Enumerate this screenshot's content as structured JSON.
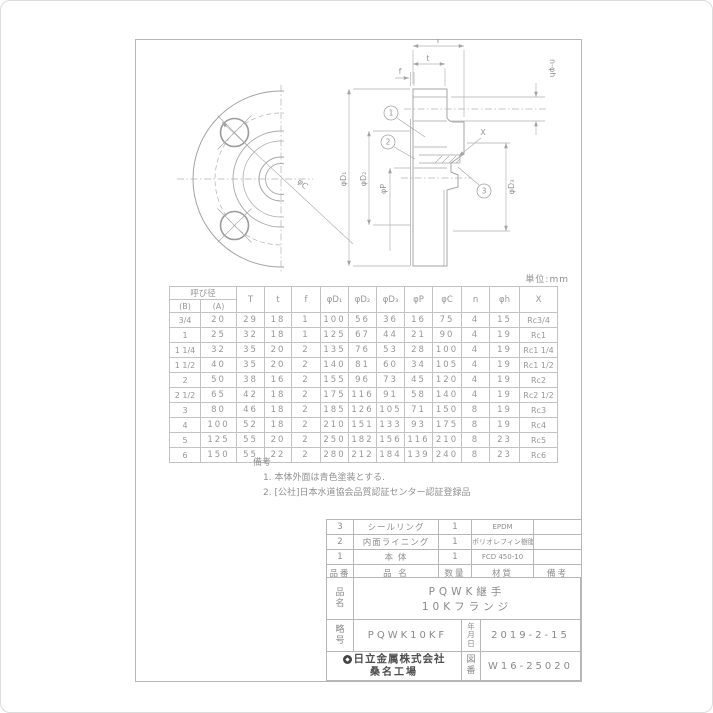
{
  "page": {
    "unit_label": "単位:mm"
  },
  "drawing": {
    "labels": {
      "T": "T",
      "t": "t",
      "f": "f",
      "n_h": "n-φh",
      "d1": "φD₁",
      "d2": "φD₂",
      "d3": "φD₃",
      "p": "φP",
      "c": "φC",
      "x": "X"
    },
    "balloons": [
      "1",
      "2",
      "3"
    ]
  },
  "dim_table": {
    "group_header": "呼び径",
    "sub_headers": [
      "(B)",
      "(A)"
    ],
    "headers": [
      "T",
      "t",
      "f",
      "φD₁",
      "φD₂",
      "φD₃",
      "φP",
      "φC",
      "n",
      "φh",
      "X"
    ],
    "rows": [
      [
        "3/4",
        "20",
        "29",
        "18",
        "1",
        "100",
        "56",
        "36",
        "16",
        "75",
        "4",
        "15",
        "Rc3/4"
      ],
      [
        "1",
        "25",
        "32",
        "18",
        "1",
        "125",
        "67",
        "44",
        "21",
        "90",
        "4",
        "19",
        "Rc1"
      ],
      [
        "1 1/4",
        "32",
        "35",
        "20",
        "2",
        "135",
        "76",
        "53",
        "28",
        "100",
        "4",
        "19",
        "Rc1 1/4"
      ],
      [
        "1 1/2",
        "40",
        "35",
        "20",
        "2",
        "140",
        "81",
        "60",
        "34",
        "105",
        "4",
        "19",
        "Rc1 1/2"
      ],
      [
        "2",
        "50",
        "38",
        "16",
        "2",
        "155",
        "96",
        "73",
        "45",
        "120",
        "4",
        "19",
        "Rc2"
      ],
      [
        "2 1/2",
        "65",
        "42",
        "18",
        "2",
        "175",
        "116",
        "91",
        "58",
        "140",
        "4",
        "19",
        "Rc2 1/2"
      ],
      [
        "3",
        "80",
        "46",
        "18",
        "2",
        "185",
        "126",
        "105",
        "71",
        "150",
        "8",
        "19",
        "Rc3"
      ],
      [
        "4",
        "100",
        "52",
        "18",
        "2",
        "210",
        "151",
        "133",
        "93",
        "175",
        "8",
        "19",
        "Rc4"
      ],
      [
        "5",
        "125",
        "55",
        "20",
        "2",
        "250",
        "182",
        "156",
        "116",
        "210",
        "8",
        "23",
        "Rc5"
      ],
      [
        "6",
        "150",
        "55",
        "22",
        "2",
        "280",
        "212",
        "184",
        "139",
        "240",
        "8",
        "23",
        "Rc6"
      ]
    ]
  },
  "notes": {
    "title": "備考",
    "items": [
      "1. 本体外面は青色塗装とする.",
      "2. [公社]日本水道協会品質認証センター認証登録品"
    ]
  },
  "parts_table": {
    "headers": [
      "品番",
      "品 名",
      "数量",
      "材質",
      "備考"
    ],
    "rows": [
      [
        "3",
        "シールリング",
        "1",
        "EPDM",
        ""
      ],
      [
        "2",
        "内面ライニング",
        "1",
        "ポリオレフィン樹脂",
        ""
      ],
      [
        "1",
        "本 体",
        "1",
        "FCD 450-10",
        ""
      ]
    ]
  },
  "title_block": {
    "name_label": "品名",
    "name_line1": "PQWK継手",
    "name_line2": "10Kフランジ",
    "code_label": "略号",
    "code_value": "PQWK10KF",
    "date_label": "年月日",
    "date_value": "2019-2-15",
    "company": "日立金属株式会社",
    "factory": "桑名工場",
    "dwg_label": "図番",
    "dwg_value": "W16-25020",
    "logo_icon": "hitachi-metals-logo"
  },
  "colors": {
    "line": "#ababab",
    "text": "#949494",
    "dark_text": "#4f4f4f"
  }
}
